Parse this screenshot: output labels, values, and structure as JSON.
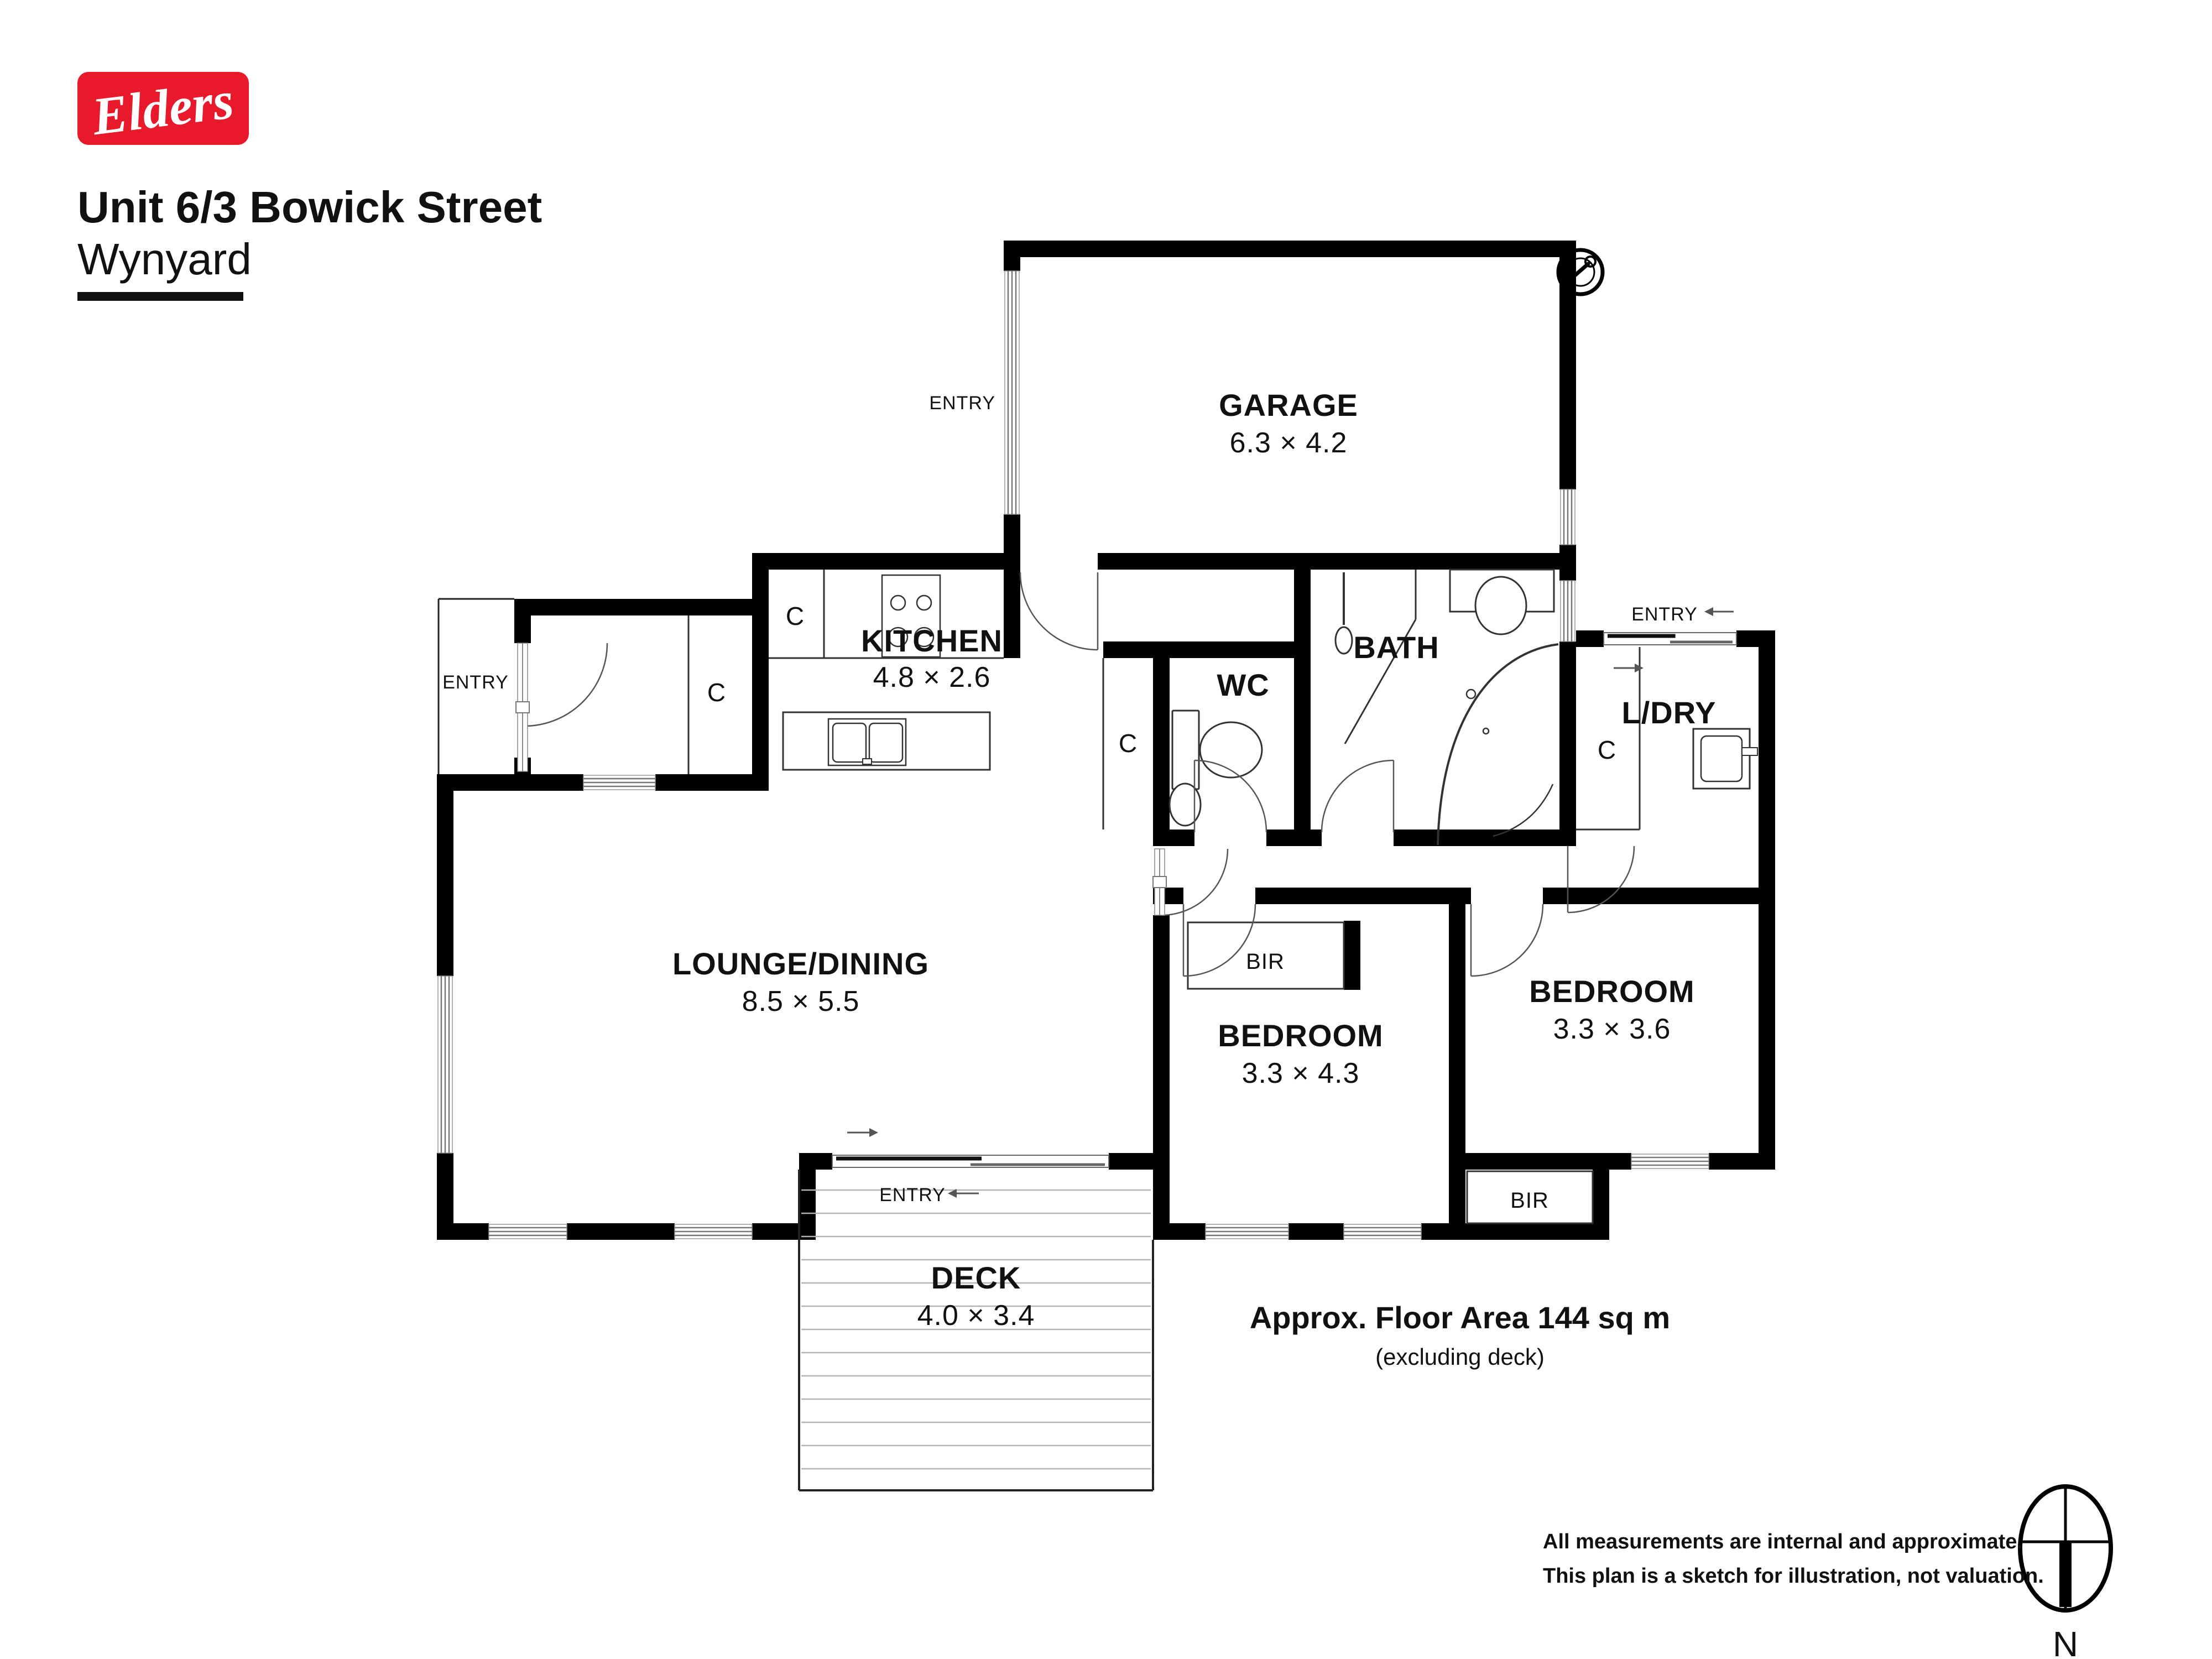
{
  "header": {
    "logo_text": "Elders",
    "address_line1": "Unit 6/3 Bowick Street",
    "address_line2": "Wynyard"
  },
  "rooms": {
    "garage": {
      "name": "GARAGE",
      "dims": "6.3 × 4.2"
    },
    "kitchen": {
      "name": "KITCHEN",
      "dims": "4.8 × 2.6"
    },
    "wc": {
      "name": "WC"
    },
    "bath": {
      "name": "BATH"
    },
    "laundry": {
      "name": "L/DRY"
    },
    "lounge": {
      "name": "LOUNGE/DINING",
      "dims": "8.5 × 5.5"
    },
    "bedroom1": {
      "name": "BEDROOM",
      "dims": "3.3 × 4.3"
    },
    "bedroom2": {
      "name": "BEDROOM",
      "dims": "3.3 × 3.6"
    },
    "deck": {
      "name": "DECK",
      "dims": "4.0 × 3.4"
    }
  },
  "labels": {
    "entry": "ENTRY",
    "closet": "C",
    "bir": "BIR",
    "north": "N"
  },
  "floor_area": {
    "line1": "Approx. Floor Area 144 sq m",
    "line2": "(excluding deck)"
  },
  "disclaimer": {
    "line1": "All measurements are internal and approximate.",
    "line2": "This plan is a sketch for illustration, not valuation."
  },
  "colors": {
    "brand_red": "#e8192b",
    "wall": "#000000"
  }
}
